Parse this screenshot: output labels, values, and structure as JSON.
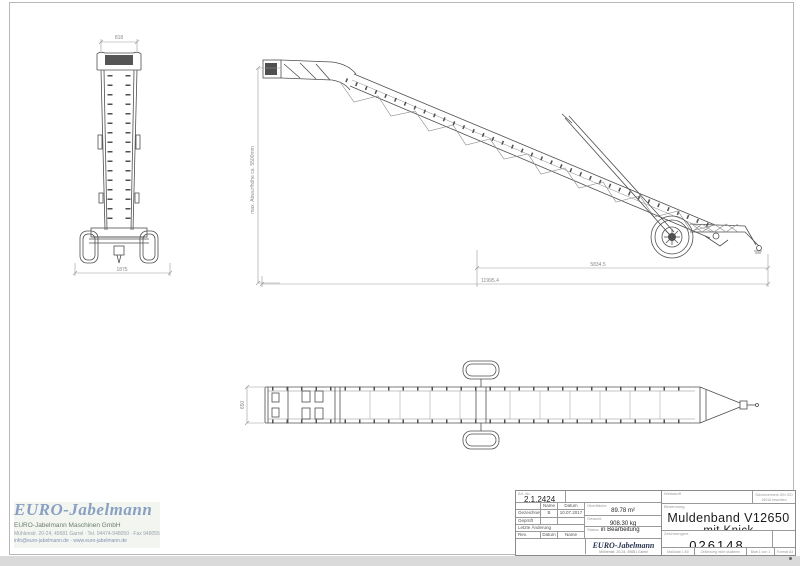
{
  "drawing": {
    "front_view": {
      "width_top": "818",
      "width_overall": "1875"
    },
    "side_view": {
      "height_note": "max. Abwurfhöhe ca. 5500mm",
      "length_axle": "5834.5",
      "length_overall": "11995.4"
    },
    "top_view": {
      "belt_width": "650"
    }
  },
  "watermark": {
    "logo": "EURO-Jabelmann",
    "line1": "EURO-Jabelmann Maschinen GmbH",
    "line2": "Mühlenstr. 20-24, 49681 Garrel · Tel. 04474-948050 · Fax 948055",
    "line3": "info@euro-jabelmann.de · www.euro-jabelmann.de"
  },
  "title_block": {
    "art_nr_label": "Art.-Nr.",
    "art_nr": "2.1.2424",
    "col_name": "Name",
    "col_datum": "Datum",
    "gezeichnet_label": "Gezeichnet",
    "gezeichnet_name": "B",
    "gezeichnet_datum": "10.07.2017",
    "geprueft_label": "Geprüft",
    "aenderung_label": "Letzte Änderung",
    "rev_label": "Rev.",
    "rev_datum": "Datum",
    "rev_name": "Name",
    "oberflaeche_label": "Oberfläche",
    "oberflaeche": "89.78 m²",
    "gewicht_label": "Gewicht",
    "gewicht": "908.30 kg",
    "status_label": "Status:",
    "status": "in Bearbeitung",
    "logo": "EURO-Jabelmann",
    "logo_addr1": "Mühlenstr. 20-24, 49681 Garrel",
    "logo_addr2": "Tel. 04474-948050 · Fax 04474-948055",
    "werkstoff_label": "Werkstoff",
    "schutz1": "Schutzvermerk DIN ISO",
    "schutz2": "16016 beachten",
    "benennung_label": "Benennung",
    "title_line1": "Muldenband V12650",
    "title_line2": "mit Knick",
    "zeichnungsnr_label": "Zeichnungsnr.",
    "zeichnungsnr": "026148",
    "massstab": "Maßstab 1:50",
    "hinweis": "Zeichnung nicht skalieren",
    "blatt": "Blatt 1 von 1",
    "format": "Format A3"
  }
}
